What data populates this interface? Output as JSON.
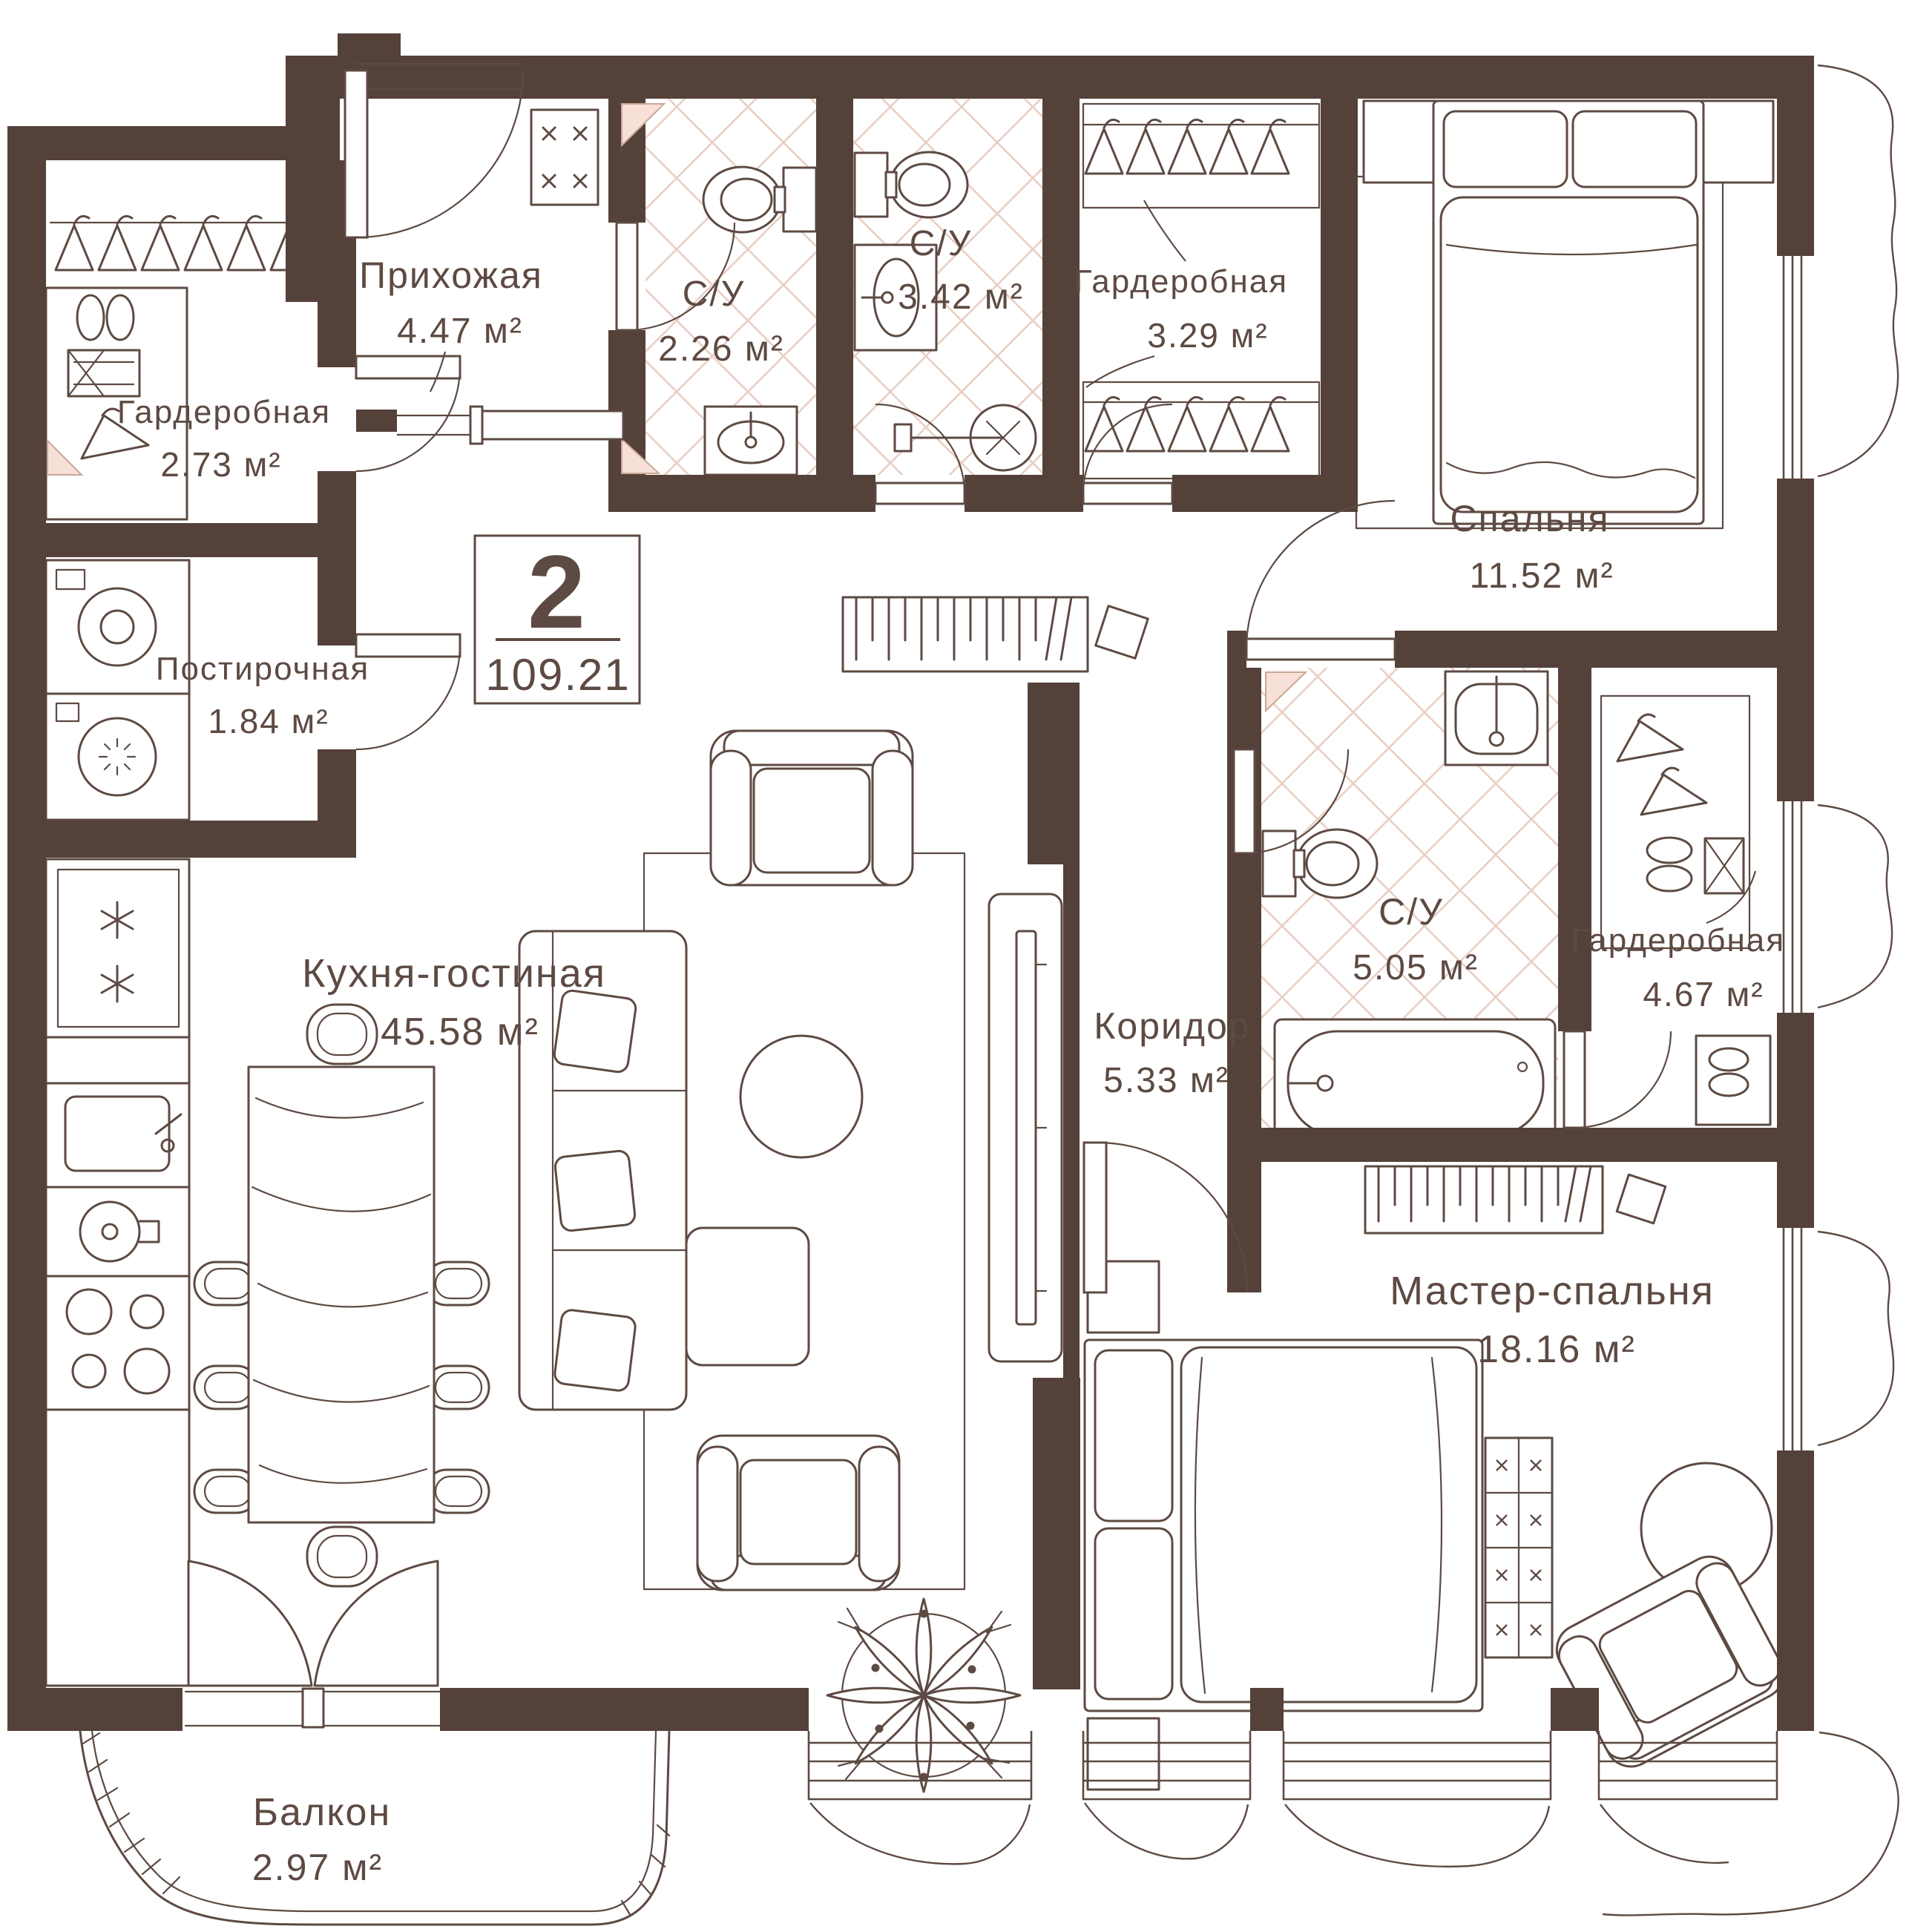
{
  "plan": {
    "badge": {
      "unit_rooms": "2",
      "total_area": "109.21"
    },
    "rooms": [
      {
        "name": "Прихожая",
        "area": "4.47 м²"
      },
      {
        "name": "С/У",
        "area": "2.26 м²"
      },
      {
        "name": "С/У",
        "area": "3.42 м²"
      },
      {
        "name": "Гардеробная",
        "area": "3.29 м²"
      },
      {
        "name": "Гардеробная",
        "area": "2.73 м²"
      },
      {
        "name": "Постирочная",
        "area": "1.84 м²"
      },
      {
        "name": "Спальня",
        "area": "11.52 м²"
      },
      {
        "name": "Кухня-гостиная",
        "area": "45.58 м²"
      },
      {
        "name": "Коридор",
        "area": "5.33 м²"
      },
      {
        "name": "С/У",
        "area": "5.05 м²"
      },
      {
        "name": "Гардеробная",
        "area": "4.67 м²"
      },
      {
        "name": "Мастер-спальня",
        "area": "18.16 м²"
      },
      {
        "name": "Балкон",
        "area": "2.97 м²"
      }
    ],
    "colors": {
      "wall": "#54413a",
      "line": "#5d4a42",
      "tile_lattice": "#e9cfc3",
      "accent_pink": "#f6e0d7",
      "background": "#ffffff"
    }
  }
}
